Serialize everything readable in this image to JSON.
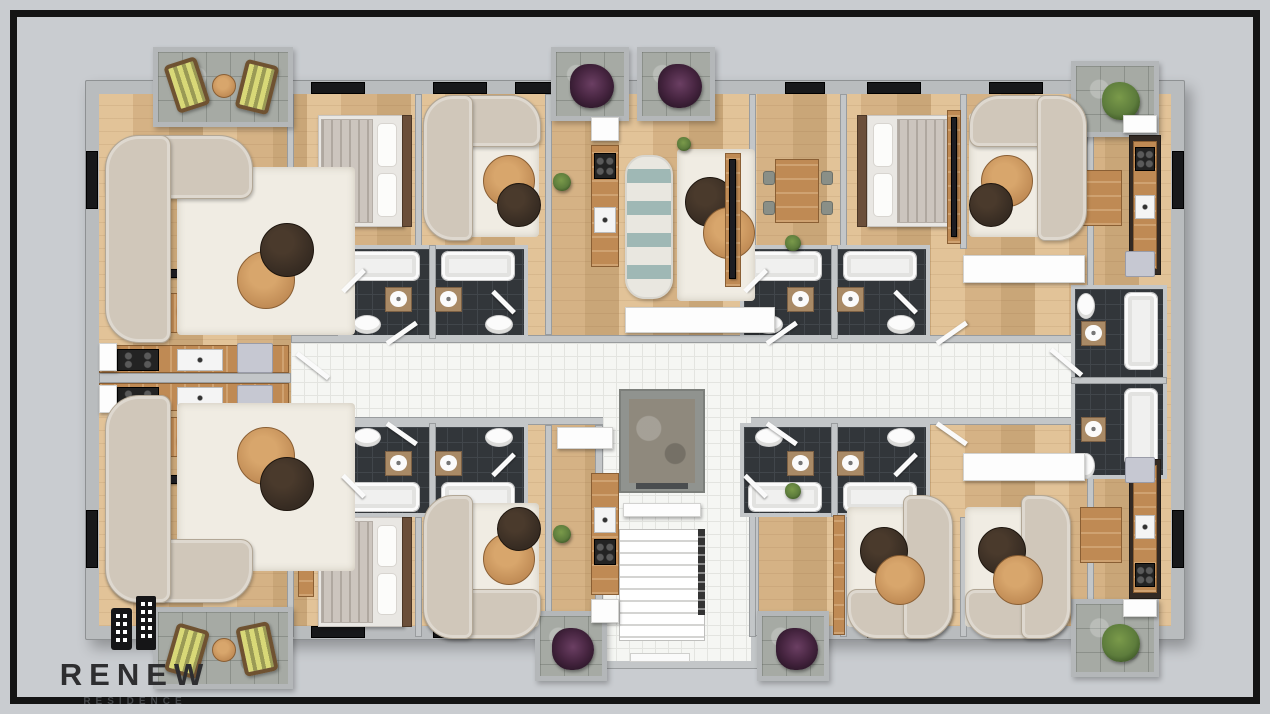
{
  "logo": {
    "brand": "RENEW",
    "sub": "RESIDENCE"
  },
  "colors": {
    "background": "#c9ccd0",
    "frame": "#141414",
    "wall": "#c3c6c8",
    "wall_dark": "#8f9294",
    "wood_light": "#e2c398",
    "wood_mid": "#d5b285",
    "wood_dark": "#c9a678",
    "corridor_tile": "#f5f6f3",
    "bath_tile": "#32363a",
    "balcony_stone": "#a6aaa4",
    "fixture_white": "#fbfbfb",
    "sofa_beige": "#d0c7ba",
    "rug": "#f0ece3",
    "accent_teal": "#9fb8b5",
    "table_wood": "#bf8a54",
    "table_dark": "#362b22",
    "plant_purple": "#45243f",
    "plant_green": "#5d7c3c",
    "lounge_stripe": "#d8d877",
    "logo_ink": "#2e2e30"
  },
  "scene": {
    "type": "3d-top-down-floor-plan",
    "features": [
      "apartments",
      "central-corridor",
      "elevator",
      "staircase",
      "bathrooms",
      "kitchens",
      "bedrooms",
      "living-rooms",
      "balconies"
    ]
  }
}
